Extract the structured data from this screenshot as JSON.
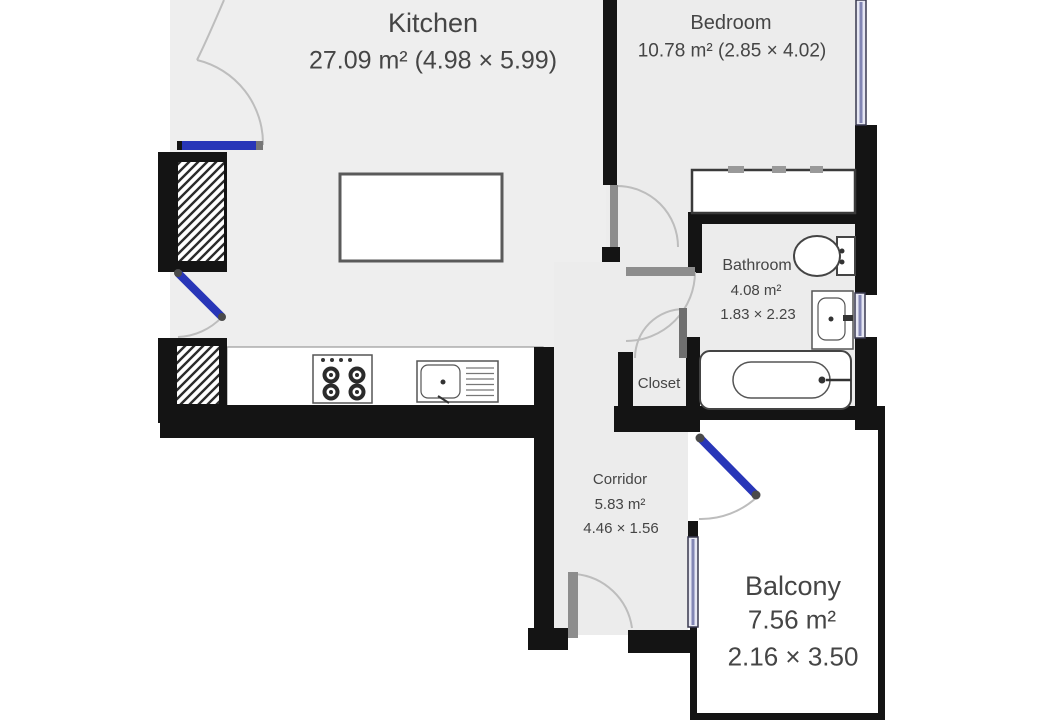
{
  "rooms": {
    "kitchen": {
      "name": "Kitchen",
      "info": "27.09 m² (4.98 × 5.99)"
    },
    "bedroom": {
      "name": "Bedroom",
      "info": "10.78 m² (2.85 × 4.02)"
    },
    "bathroom": {
      "name": "Bathroom",
      "area": "4.08 m²",
      "dims": "1.83 × 2.23"
    },
    "closet": {
      "name": "Closet"
    },
    "corridor": {
      "name": "Corridor",
      "area": "5.83 m²",
      "dims": "4.46 × 1.56"
    },
    "balcony": {
      "name": "Balcony",
      "area": "7.56 m²",
      "dims": "2.16 × 3.50"
    }
  },
  "fixtures": [
    "kitchen-island",
    "stove",
    "kitchen-sink",
    "counter",
    "wardrobe",
    "toilet",
    "washbasin",
    "bathtub",
    "shaft-upper",
    "shaft-lower"
  ],
  "doors": [
    "kitchen-left-upper-door",
    "kitchen-left-lower-door",
    "bedroom-door",
    "bathroom-door",
    "closet-door",
    "balcony-door",
    "entrance-door"
  ],
  "windows": [
    "bedroom-window",
    "bathroom-window",
    "corridor-window"
  ],
  "colors": {
    "wall": "#141414",
    "floor": "#eeeeee",
    "balcony_floor": "#ffffff",
    "window_fill": "#e6e7f3",
    "window_line": "#8286b4",
    "door_blue": "#2836b8",
    "door_leaf": "#8d8d8d",
    "swing_arc": "#bdbdbd",
    "fixture_outline": "#444444",
    "label_text": "#454545"
  }
}
